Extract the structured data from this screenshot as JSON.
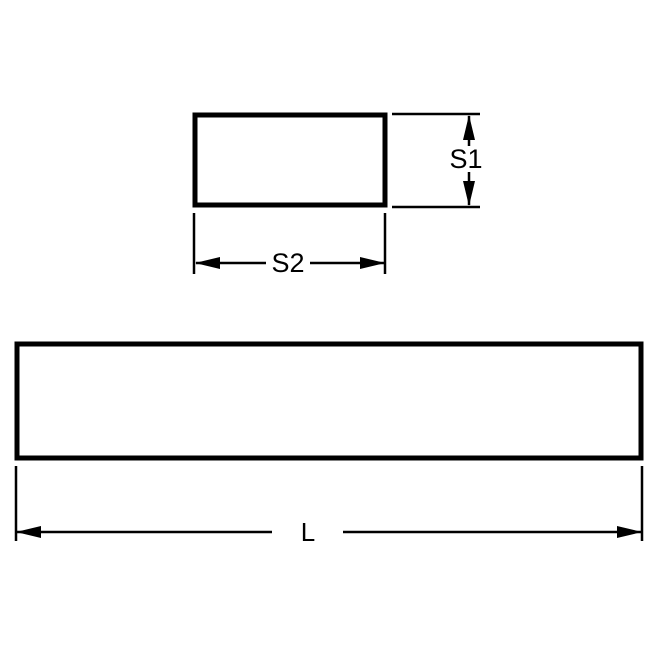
{
  "drawing": {
    "labels": {
      "s1": "S1",
      "s2": "S2",
      "l": "L"
    },
    "colors": {
      "ink": "#000000",
      "background": "#ffffff"
    },
    "icons": {
      "arrowhead": "solid-triangle"
    }
  }
}
